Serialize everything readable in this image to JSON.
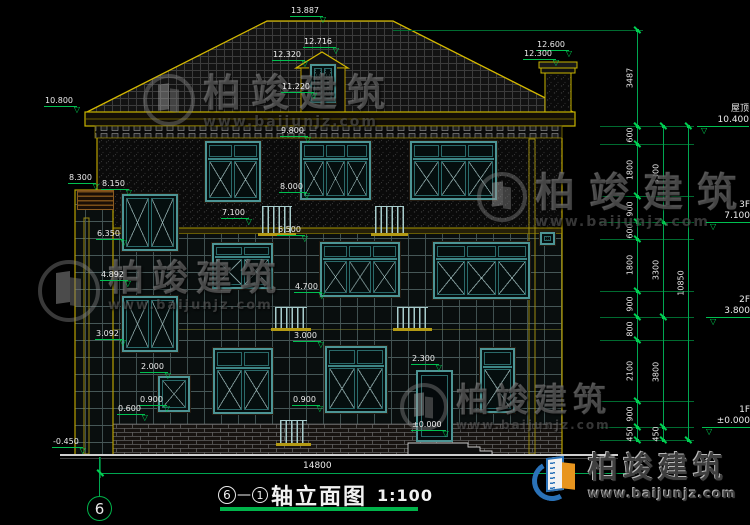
{
  "drawing": {
    "title": {
      "axis_start": "6",
      "separator": "—",
      "axis_end": "1",
      "name": "轴立面图",
      "scale": "1:100"
    },
    "axis_bubble_label": "6",
    "bottom_dim": {
      "label": "14800"
    },
    "brand": {
      "name": "柏竣建筑",
      "url": "www.baijunjz.com"
    },
    "colors": {
      "cad_green": "#00a651",
      "bright_green": "#00d052",
      "outline_yellow": "#c8b400",
      "window_teal": "#4d9595",
      "brand_blue": "#2a72b8",
      "brand_orange": "#e8951e"
    },
    "floor_levels": [
      {
        "zh": "屋顶",
        "value": "10.400",
        "x": 697,
        "y": 92,
        "w": 52,
        "line_y": 126
      },
      {
        "zh": "3F",
        "value": "7.100",
        "x": 706,
        "y": 194,
        "w": 44,
        "line_y": 222
      },
      {
        "zh": "2F",
        "value": "3.800",
        "x": 706,
        "y": 290,
        "w": 44,
        "line_y": 317
      },
      {
        "zh": "1F",
        "value": "±0.000",
        "x": 702,
        "y": 400,
        "w": 48,
        "line_y": 427
      }
    ],
    "annotations": [
      {
        "text": "13.887",
        "x": 290,
        "y": 6
      },
      {
        "text": "12.716",
        "x": 303,
        "y": 37
      },
      {
        "text": "12.320",
        "x": 272,
        "y": 50
      },
      {
        "text": "11.220",
        "x": 281,
        "y": 82
      },
      {
        "text": "12.600",
        "x": 536,
        "y": 40
      },
      {
        "text": "12.300",
        "x": 523,
        "y": 49
      },
      {
        "text": "10.800",
        "x": 44,
        "y": 96
      },
      {
        "text": "9.800",
        "x": 280,
        "y": 126
      },
      {
        "text": "8.300",
        "x": 68,
        "y": 173
      },
      {
        "text": "8.150",
        "x": 101,
        "y": 179
      },
      {
        "text": "8.000",
        "x": 279,
        "y": 182
      },
      {
        "text": "7.100",
        "x": 221,
        "y": 208
      },
      {
        "text": "6.500",
        "x": 277,
        "y": 225
      },
      {
        "text": "6.350",
        "x": 96,
        "y": 229
      },
      {
        "text": "4.892",
        "x": 100,
        "y": 270
      },
      {
        "text": "4.700",
        "x": 294,
        "y": 282
      },
      {
        "text": "3.092",
        "x": 95,
        "y": 329
      },
      {
        "text": "3.000",
        "x": 293,
        "y": 331
      },
      {
        "text": "2.300",
        "x": 411,
        "y": 354
      },
      {
        "text": "2.000",
        "x": 140,
        "y": 362
      },
      {
        "text": "0.900",
        "x": 139,
        "y": 395
      },
      {
        "text": "0.900",
        "x": 292,
        "y": 395
      },
      {
        "text": "0.600",
        "x": 117,
        "y": 404
      },
      {
        "text": "±0.000",
        "x": 411,
        "y": 420
      },
      {
        "text": "-0.450",
        "x": 52,
        "y": 437
      }
    ],
    "chains": [
      {
        "x": 637,
        "pts": [
          30,
          126
        ],
        "labels": [
          "3487"
        ]
      },
      {
        "x": 637,
        "pts": [
          126,
          144,
          196,
          222,
          239,
          291,
          317,
          340,
          401,
          427,
          440
        ],
        "labels": [
          "600",
          "1800",
          "900",
          "600",
          "1800",
          "900",
          "800",
          "2100",
          "900",
          "450"
        ]
      },
      {
        "x": 663,
        "pts": [
          126,
          222,
          317,
          427,
          440
        ],
        "labels": [
          "3300",
          "3300",
          "3800",
          "450"
        ]
      },
      {
        "x": 688,
        "pts": [
          126,
          440
        ],
        "labels": [
          "10850"
        ]
      }
    ],
    "ext_lines_y": [
      126,
      144,
      196,
      222,
      239,
      291,
      317,
      340,
      401,
      427,
      440
    ],
    "windows": [
      {
        "x": 205,
        "y": 141,
        "w": 56,
        "h": 61,
        "cols": 2,
        "transom": true
      },
      {
        "x": 300,
        "y": 141,
        "w": 71,
        "h": 59,
        "cols": 3,
        "transom": true
      },
      {
        "x": 410,
        "y": 141,
        "w": 87,
        "h": 59,
        "cols": 3,
        "transom": true
      },
      {
        "x": 122,
        "y": 194,
        "w": 56,
        "h": 57,
        "cols": 2,
        "transom": false
      },
      {
        "x": 122,
        "y": 296,
        "w": 56,
        "h": 56,
        "cols": 2,
        "transom": false
      },
      {
        "x": 212,
        "y": 243,
        "w": 61,
        "h": 46,
        "cols": 2,
        "transom": true
      },
      {
        "x": 320,
        "y": 242,
        "w": 80,
        "h": 55,
        "cols": 3,
        "transom": true
      },
      {
        "x": 433,
        "y": 242,
        "w": 97,
        "h": 57,
        "cols": 3,
        "transom": true
      },
      {
        "x": 540,
        "y": 232,
        "w": 15,
        "h": 13,
        "cols": 1,
        "transom": false
      },
      {
        "x": 213,
        "y": 348,
        "w": 60,
        "h": 66,
        "cols": 2,
        "transom": true
      },
      {
        "x": 325,
        "y": 346,
        "w": 62,
        "h": 67,
        "cols": 2,
        "transom": true
      },
      {
        "x": 480,
        "y": 348,
        "w": 35,
        "h": 65,
        "cols": 1,
        "transom": true
      },
      {
        "x": 158,
        "y": 376,
        "w": 32,
        "h": 36,
        "cols": 1,
        "transom": false
      },
      {
        "x": 310,
        "y": 64,
        "w": 26,
        "h": 39,
        "cols": 2,
        "transom": false
      }
    ],
    "door": {
      "x": 416,
      "y": 370,
      "w": 37,
      "h": 72
    },
    "railings": [
      {
        "x": 262,
        "y": 206,
        "w": 30,
        "h": 26
      },
      {
        "x": 375,
        "y": 206,
        "w": 29,
        "h": 26
      },
      {
        "x": 275,
        "y": 307,
        "w": 32,
        "h": 20
      },
      {
        "x": 397,
        "y": 307,
        "w": 31,
        "h": 20
      },
      {
        "x": 280,
        "y": 420,
        "w": 27,
        "h": 22
      }
    ],
    "louver": {
      "x": 77,
      "y": 190,
      "w": 35,
      "h": 18
    },
    "watermarks": [
      {
        "x": 143,
        "y": 74,
        "logo": 52,
        "size": 38,
        "ls": 10,
        "us": 14,
        "text": "柏竣建筑",
        "url": "www.baijunjz.com"
      },
      {
        "x": 38,
        "y": 260,
        "logo": 62,
        "size": 36,
        "ls": 8,
        "us": 13,
        "text": "柏竣建筑",
        "url": "www.baijunjz.com"
      },
      {
        "x": 477,
        "y": 172,
        "logo": 50,
        "size": 40,
        "ls": 14,
        "us": 14,
        "text": "柏竣建筑",
        "url": "www.baijunjz.com"
      },
      {
        "x": 400,
        "y": 383,
        "logo": 48,
        "size": 33,
        "ls": 6,
        "us": 12,
        "text": "柏竣建筑",
        "url": "www.baijunjz.com"
      }
    ]
  }
}
